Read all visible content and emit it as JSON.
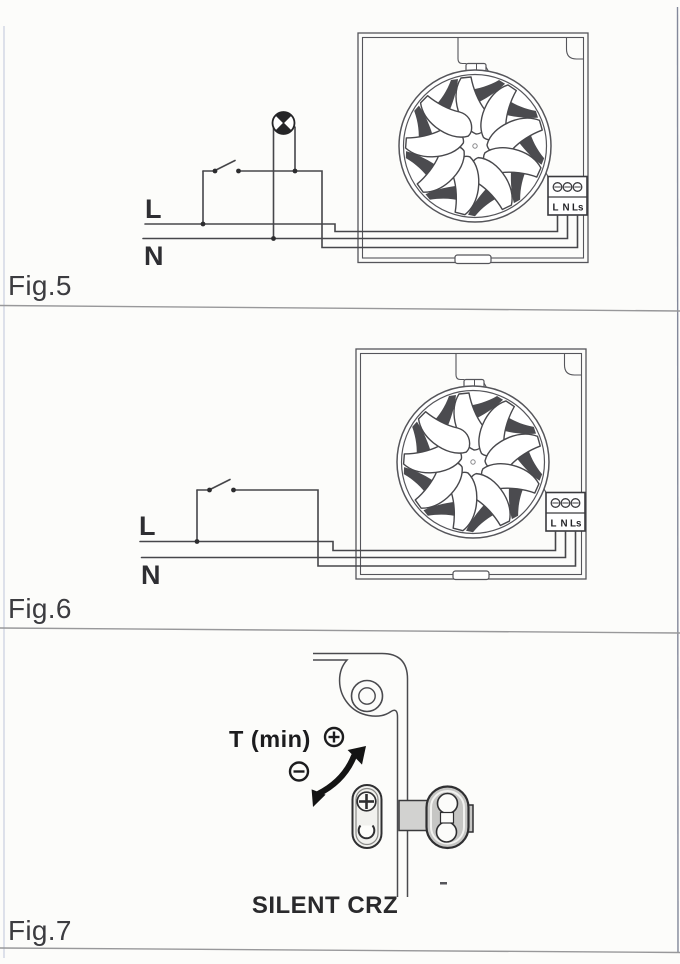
{
  "figures": {
    "fig5": {
      "caption": "Fig.5",
      "live_label": "L",
      "neutral_label": "N",
      "terminal_labels": [
        "L",
        "N",
        "Ls"
      ],
      "components": [
        "lamp",
        "switch",
        "fan-unit",
        "terminal-block"
      ]
    },
    "fig6": {
      "caption": "Fig.6",
      "live_label": "L",
      "neutral_label": "N",
      "terminal_labels": [
        "L",
        "N",
        "Ls"
      ],
      "components": [
        "switch",
        "fan-unit",
        "terminal-block"
      ]
    },
    "fig7": {
      "caption": "Fig.7",
      "timer_label": "T (min)",
      "product_name": "SILENT CRZ",
      "plus_icon": "circle-plus",
      "minus_icon": "circle-minus",
      "arrow_icon": "curved-double-arrow",
      "components": [
        "panel-corner-grommet",
        "timer-adjust-screw",
        "connector-block"
      ]
    }
  },
  "colors": {
    "background": "#fcfcfa",
    "diagram_line": "#4a4a4e",
    "text": "#3c3c40",
    "divider": "#98989a",
    "arrow": "#141414",
    "component_gray": "#c6c6c4"
  }
}
